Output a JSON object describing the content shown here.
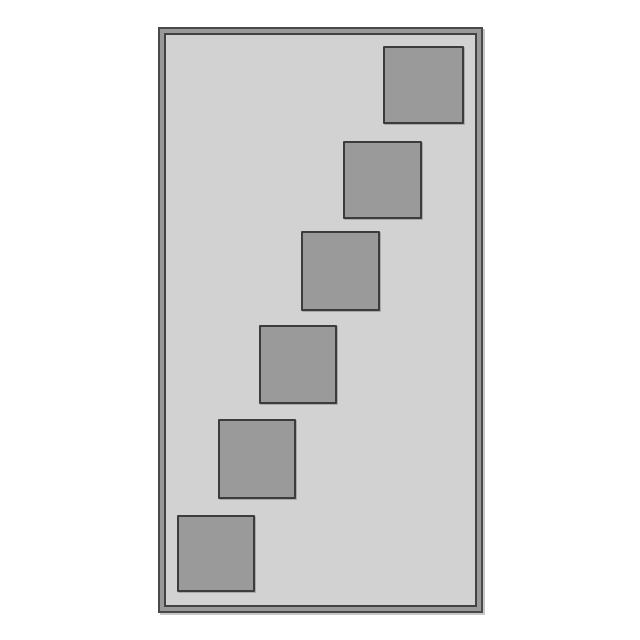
{
  "canvas": {
    "width": 640,
    "height": 640
  },
  "colors": {
    "page_bg": "#ffffff",
    "frame_band": "#999999",
    "frame_stroke": "#4a4a4a",
    "frame_inner_stroke": "#424242",
    "frame_fill": "#d2d2d2",
    "square_fill": "#9a9a9a",
    "square_stroke": "#3c3c3c"
  },
  "frame": {
    "x": 158,
    "y": 27,
    "width": 325,
    "height": 586
  },
  "squares": [
    {
      "x": 383,
      "y": 46,
      "width": 81,
      "height": 78
    },
    {
      "x": 343,
      "y": 141,
      "width": 79,
      "height": 78
    },
    {
      "x": 301,
      "y": 231,
      "width": 79,
      "height": 80
    },
    {
      "x": 259,
      "y": 325,
      "width": 78,
      "height": 79
    },
    {
      "x": 218,
      "y": 419,
      "width": 78,
      "height": 80
    },
    {
      "x": 177,
      "y": 515,
      "width": 78,
      "height": 77
    }
  ]
}
